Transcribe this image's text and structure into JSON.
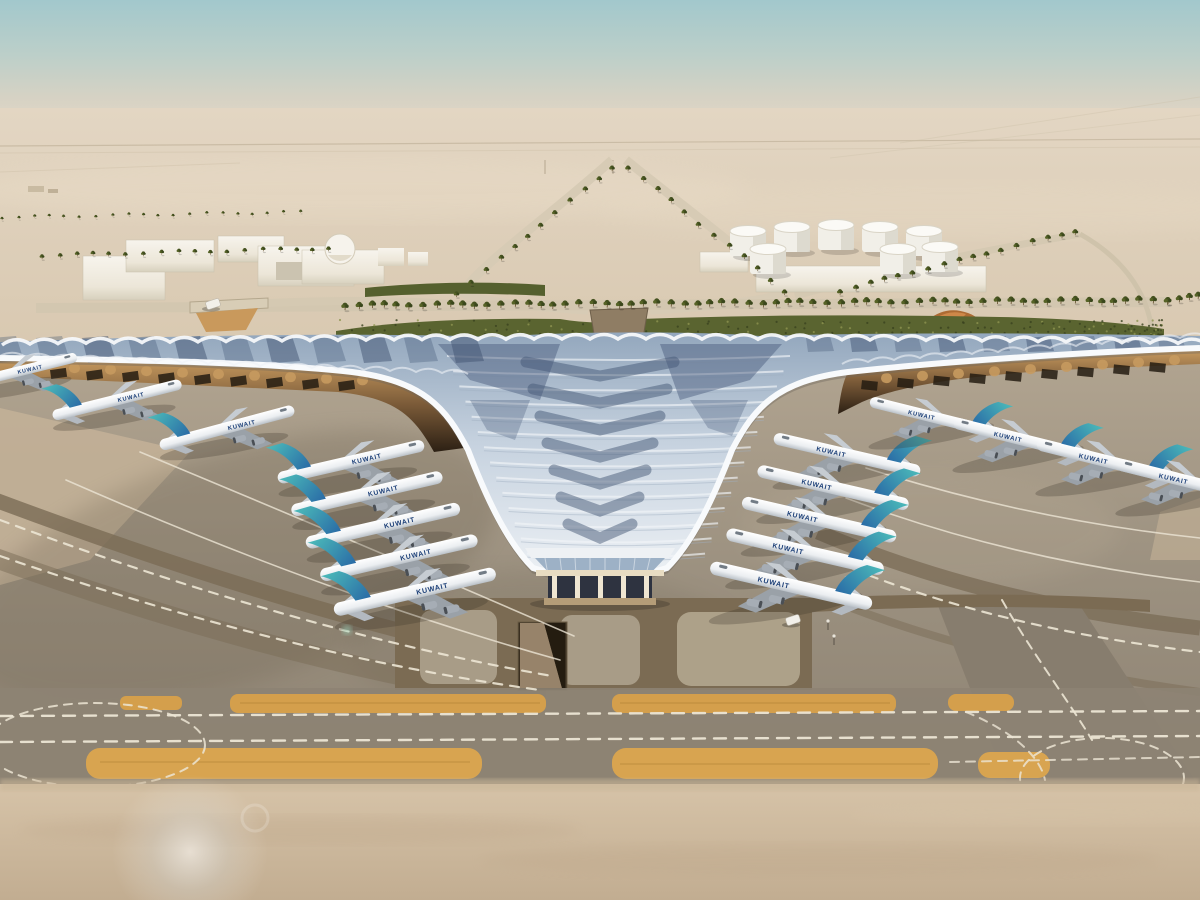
{
  "meta": {
    "description": "Aerial rendering of a desert airport: trefoil terminal with rippled blue-white roof, Kuwait Airways jets parked at both piers, taxiways and sand foreground"
  },
  "scene": {
    "palette": {
      "sky_top": "#a2c8cc",
      "sky_haze": "#ded3c4",
      "desert": "#ddcfb8",
      "sand_foreground": "#ccb89c",
      "apron_grey": "#a19683",
      "apron_dark": "#8d8272",
      "band_brown": "#7b6b53",
      "strip_orange": "#d49f4c",
      "marking_white": "#ece5d4",
      "hedge_green": "#5a6430",
      "palm_green": "#44511f",
      "roof_light": "#e9eef3",
      "roof_mid": "#b7c5d6",
      "roof_dark_panel": "#3d5271",
      "roof_edge_white": "#f8fafc",
      "canopy_amber": "#c79a5f",
      "canopy_dark": "#2c2014",
      "colonnade_beige": "#c7ad84"
    },
    "airline": {
      "label": "KUWAIT",
      "tail_teal": "#4cbcba",
      "tail_blue": "#2a6ba6",
      "title_blue": "#1c3f77"
    },
    "aircraft": [
      {
        "x": 18,
        "y": 372,
        "scale": 0.78,
        "rot": -14,
        "mirror": false,
        "label": "KUWAIT"
      },
      {
        "x": 118,
        "y": 400,
        "scale": 0.84,
        "rot": -14,
        "mirror": false,
        "label": "KUWAIT"
      },
      {
        "x": 228,
        "y": 428,
        "scale": 0.88,
        "rot": -15,
        "mirror": false,
        "label": "KUWAIT"
      },
      {
        "x": 352,
        "y": 462,
        "scale": 0.95,
        "rot": -13,
        "mirror": false,
        "label": "KUWAIT"
      },
      {
        "x": 368,
        "y": 494,
        "scale": 0.98,
        "rot": -13,
        "mirror": false,
        "label": "KUWAIT"
      },
      {
        "x": 384,
        "y": 526,
        "scale": 1.0,
        "rot": -13,
        "mirror": false,
        "label": "KUWAIT"
      },
      {
        "x": 400,
        "y": 558,
        "scale": 1.02,
        "rot": -13,
        "mirror": false,
        "label": "KUWAIT"
      },
      {
        "x": 416,
        "y": 592,
        "scale": 1.05,
        "rot": -13,
        "mirror": false,
        "label": "KUWAIT"
      },
      {
        "x": 846,
        "y": 455,
        "scale": 0.95,
        "rot": 13,
        "mirror": true,
        "label": "KUWAIT"
      },
      {
        "x": 832,
        "y": 488,
        "scale": 0.98,
        "rot": 13,
        "mirror": true,
        "label": "KUWAIT"
      },
      {
        "x": 818,
        "y": 520,
        "scale": 1.0,
        "rot": 13,
        "mirror": true,
        "label": "KUWAIT"
      },
      {
        "x": 804,
        "y": 552,
        "scale": 1.02,
        "rot": 13,
        "mirror": true,
        "label": "KUWAIT"
      },
      {
        "x": 790,
        "y": 586,
        "scale": 1.05,
        "rot": 13,
        "mirror": true,
        "label": "KUWAIT"
      },
      {
        "x": 935,
        "y": 418,
        "scale": 0.86,
        "rot": 14,
        "mirror": true,
        "label": "KUWAIT"
      },
      {
        "x": 1022,
        "y": 440,
        "scale": 0.9,
        "rot": 14,
        "mirror": true,
        "label": "KUWAIT"
      },
      {
        "x": 1108,
        "y": 462,
        "scale": 0.94,
        "rot": 14,
        "mirror": true,
        "label": "KUWAIT"
      },
      {
        "x": 1188,
        "y": 482,
        "scale": 0.94,
        "rot": 14,
        "mirror": true,
        "label": "KUWAIT"
      }
    ],
    "palm_rows": [
      {
        "x1": 345,
        "y1": 309,
        "x2": 1166,
        "y2": 304,
        "n": 64,
        "s": 1.0
      },
      {
        "x1": 612,
        "y1": 170,
        "x2": 458,
        "y2": 296,
        "n": 12,
        "s": 0.75
      },
      {
        "x1": 628,
        "y1": 170,
        "x2": 786,
        "y2": 294,
        "n": 12,
        "s": 0.75
      },
      {
        "x1": 42,
        "y1": 258,
        "x2": 330,
        "y2": 251,
        "n": 18,
        "s": 0.65
      },
      {
        "x1": 840,
        "y1": 294,
        "x2": 1076,
        "y2": 234,
        "n": 17,
        "s": 0.8
      },
      {
        "x1": 2,
        "y1": 219,
        "x2": 300,
        "y2": 214,
        "n": 20,
        "s": 0.45
      },
      {
        "x1": 1168,
        "y1": 303,
        "x2": 1198,
        "y2": 300,
        "n": 4,
        "s": 0.95
      }
    ],
    "tanks": [
      {
        "x": 748,
        "y": 242
      },
      {
        "x": 792,
        "y": 238
      },
      {
        "x": 836,
        "y": 236
      },
      {
        "x": 880,
        "y": 238
      },
      {
        "x": 924,
        "y": 242
      },
      {
        "x": 768,
        "y": 260
      },
      {
        "x": 898,
        "y": 260
      },
      {
        "x": 940,
        "y": 258
      }
    ],
    "vehicles": [
      {
        "type": "service-van",
        "x": 793,
        "y": 620
      },
      {
        "type": "car",
        "x": 213,
        "y": 304
      }
    ]
  }
}
